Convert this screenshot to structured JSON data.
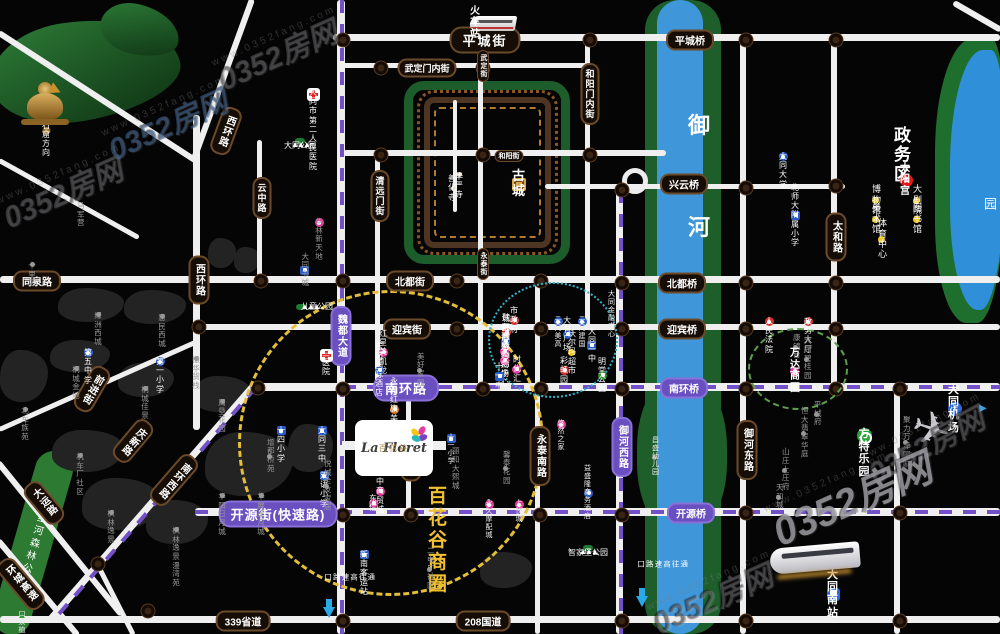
{
  "watermark": {
    "brand": "0352房网",
    "url": "www.0352fang.com"
  },
  "logo": {
    "latin": "La Floret",
    "cn": "百花谷"
  },
  "map": {
    "texts": {
      "shilihe": "十里河森林公园"
    },
    "colors": {
      "road": "#efefef",
      "river": "#3f96d8",
      "bank": "#1d5e2b",
      "route_dash": "#7150c8",
      "badge_dark": "#160d06",
      "badge_purple": "#6a4fc0",
      "circle_yellow": "#e2be3a",
      "circle_teal": "#35b0c5",
      "circle_green": "#5f9e4d",
      "biz_yellow": "#f0c030"
    },
    "roads": [
      [
        333,
        34,
        667,
        7,
        0
      ],
      [
        343,
        63,
        250,
        5,
        0
      ],
      [
        343,
        150,
        323,
        6,
        0
      ],
      [
        545,
        184,
        300,
        5,
        0
      ],
      [
        0,
        276,
        1000,
        7,
        0
      ],
      [
        197,
        324,
        803,
        6,
        0
      ],
      [
        258,
        383,
        742,
        8,
        0
      ],
      [
        195,
        508,
        805,
        8,
        0
      ],
      [
        0,
        616,
        1000,
        7,
        0
      ],
      [
        337,
        0,
        634,
        8,
        90
      ],
      [
        478,
        37,
        353,
        5,
        90
      ],
      [
        585,
        37,
        293,
        5,
        90
      ],
      [
        375,
        150,
        240,
        5,
        90
      ],
      [
        257,
        140,
        141,
        5,
        90
      ],
      [
        193,
        115,
        315,
        7,
        90
      ],
      [
        616,
        185,
        449,
        7,
        90
      ],
      [
        740,
        37,
        597,
        6,
        90
      ],
      [
        831,
        37,
        353,
        6,
        90
      ],
      [
        894,
        386,
        248,
        6,
        90
      ],
      [
        406,
        386,
        129,
        5,
        90
      ],
      [
        535,
        278,
        356,
        5,
        90
      ],
      [
        453,
        100,
        112,
        4,
        90
      ],
      [
        255,
        0,
        170,
        6,
        110
      ],
      [
        0,
        30,
        236,
        6,
        33
      ],
      [
        0,
        158,
        160,
        5,
        29
      ],
      [
        258,
        386,
        314,
        7,
        131
      ],
      [
        200,
        343,
        219,
        5,
        156
      ],
      [
        0,
        460,
        197,
        6,
        51
      ],
      [
        0,
        538,
        125,
        6,
        50
      ],
      [
        98,
        560,
        83,
        5,
        63
      ],
      [
        955,
        0,
        55,
        6,
        30
      ]
    ],
    "route_dashes": [
      [
        340,
        0,
        634,
        4,
        90
      ],
      [
        619,
        190,
        444,
        4,
        90
      ],
      [
        343,
        385,
        657,
        4,
        0
      ],
      [
        195,
        510,
        805,
        4,
        0
      ],
      [
        258,
        388,
        310,
        4,
        131
      ]
    ],
    "junctions": [
      [
        343,
        40
      ],
      [
        457,
        40
      ],
      [
        590,
        40
      ],
      [
        746,
        40
      ],
      [
        836,
        40
      ],
      [
        381,
        68
      ],
      [
        483,
        68
      ],
      [
        381,
        155
      ],
      [
        483,
        155
      ],
      [
        590,
        155
      ],
      [
        622,
        190
      ],
      [
        746,
        188
      ],
      [
        836,
        186
      ],
      [
        261,
        281
      ],
      [
        343,
        281
      ],
      [
        457,
        281
      ],
      [
        541,
        281
      ],
      [
        622,
        283
      ],
      [
        746,
        283
      ],
      [
        836,
        283
      ],
      [
        199,
        327
      ],
      [
        343,
        329
      ],
      [
        457,
        329
      ],
      [
        541,
        329
      ],
      [
        622,
        329
      ],
      [
        746,
        329
      ],
      [
        836,
        329
      ],
      [
        258,
        388
      ],
      [
        343,
        389
      ],
      [
        411,
        389
      ],
      [
        483,
        389
      ],
      [
        541,
        389
      ],
      [
        622,
        389
      ],
      [
        746,
        389
      ],
      [
        836,
        389
      ],
      [
        900,
        389
      ],
      [
        343,
        515
      ],
      [
        411,
        515
      ],
      [
        540,
        515
      ],
      [
        622,
        515
      ],
      [
        746,
        513
      ],
      [
        900,
        513
      ],
      [
        343,
        621
      ],
      [
        622,
        621
      ],
      [
        746,
        621
      ],
      [
        900,
        621
      ],
      [
        98,
        564
      ],
      [
        148,
        611
      ]
    ],
    "blocks": [
      [
        58,
        288,
        66,
        34
      ],
      [
        124,
        290,
        62,
        34
      ],
      [
        50,
        340,
        60,
        32
      ],
      [
        0,
        350,
        48,
        52
      ],
      [
        118,
        363,
        56,
        34
      ],
      [
        193,
        376,
        58,
        36
      ],
      [
        52,
        430,
        72,
        42
      ],
      [
        82,
        478,
        78,
        52
      ],
      [
        146,
        500,
        62,
        44
      ],
      [
        205,
        432,
        88,
        64
      ],
      [
        288,
        424,
        45,
        48
      ],
      [
        208,
        238,
        28,
        30
      ],
      [
        234,
        247,
        26,
        26
      ],
      [
        480,
        552,
        52,
        36
      ]
    ],
    "road_badges": [
      [
        "平城街",
        485,
        40,
        "h",
        "db",
        0
      ],
      [
        "平城桥",
        690,
        40,
        "h",
        "d",
        0
      ],
      [
        "武定门内街",
        427,
        68,
        "h",
        "ds",
        0
      ],
      [
        "武定街",
        483,
        66,
        "v",
        "dt",
        0
      ],
      [
        "和阳门内街",
        590,
        94,
        "v",
        "ds",
        0
      ],
      [
        "西环路",
        226,
        131,
        "v",
        "d",
        20
      ],
      [
        "西环路",
        199,
        280,
        "v",
        "d",
        0
      ],
      [
        "云中路",
        262,
        198,
        "v",
        "ds",
        0
      ],
      [
        "清远门街",
        380,
        196,
        "v",
        "ds",
        0
      ],
      [
        "和阳街",
        509,
        156,
        "h",
        "dt",
        0
      ],
      [
        "永泰街",
        483,
        264,
        "v",
        "dt",
        0
      ],
      [
        "同泉路",
        37,
        281,
        "h",
        "d",
        0
      ],
      [
        "北都街",
        410,
        281,
        "h",
        "d",
        0
      ],
      [
        "迎宾街",
        407,
        329,
        "h",
        "d",
        0
      ],
      [
        "兴云桥",
        684,
        184,
        "h",
        "d",
        0
      ],
      [
        "北都桥",
        682,
        283,
        "h",
        "d",
        0
      ],
      [
        "迎宾桥",
        682,
        329,
        "h",
        "d",
        0
      ],
      [
        "太和路",
        836,
        237,
        "v",
        "d",
        0
      ],
      [
        "御河东路",
        747,
        450,
        "v",
        "d",
        0
      ],
      [
        "红旗街",
        411,
        457,
        "v",
        "d",
        0
      ],
      [
        "永泰南路",
        540,
        456,
        "v",
        "d",
        0
      ],
      [
        "南环西路",
        174,
        480,
        "v",
        "d",
        41
      ],
      [
        "前进街",
        92,
        389,
        "v",
        "d",
        30
      ],
      [
        "大运路",
        44,
        503,
        "v",
        "d",
        -40
      ],
      [
        "环城高速",
        21,
        584,
        "v",
        "d",
        -40
      ],
      [
        "庆新路",
        133,
        441,
        "v",
        "d",
        40
      ],
      [
        "339省道",
        243,
        621,
        "h",
        "d",
        0
      ],
      [
        "208国道",
        483,
        621,
        "h",
        "d",
        0
      ],
      [
        "魏都大道",
        341,
        336,
        "v",
        "p",
        0
      ],
      [
        "御河西路",
        622,
        447,
        "v",
        "p",
        0
      ],
      [
        "南环路",
        406,
        388,
        "h",
        "pb",
        0
      ],
      [
        "南环桥",
        684,
        388,
        "h",
        "p",
        0
      ],
      [
        "开源街(快速路)",
        278,
        514,
        "h",
        "pb",
        0
      ],
      [
        "开源桥",
        691,
        513,
        "h",
        "p",
        0
      ]
    ],
    "pois": [
      [
        "火车站",
        470,
        23,
        "b10",
        "train",
        "l"
      ],
      [
        "云冈石窟方向",
        42,
        130,
        "w8",
        "golddot",
        "l"
      ],
      [
        "大同市第二\n人民医院",
        313,
        88,
        "w8",
        "cross",
        "t"
      ],
      [
        "大同公园",
        300,
        141,
        "pk",
        "trees",
        "t"
      ],
      [
        "古城",
        512,
        184,
        "b12",
        "goldcity",
        "l"
      ],
      [
        "华严寺",
        459,
        172,
        "w8",
        "wdot",
        "t"
      ],
      [
        "善化寺",
        456,
        188,
        "w8",
        "wdot",
        "r"
      ],
      [
        "政务区",
        894,
        155,
        "big",
        null,
        null
      ],
      [
        "太阳宫",
        900,
        180,
        "b10",
        "redstar",
        "l"
      ],
      [
        "博物馆",
        872,
        200,
        "w9",
        "ydot",
        "l"
      ],
      [
        "大剧院",
        913,
        200,
        "w9",
        "ydot",
        "l"
      ],
      [
        "美术馆",
        872,
        219,
        "w9",
        "ydot",
        "l"
      ],
      [
        "图书馆",
        913,
        219,
        "w9",
        "ydot",
        "l"
      ],
      [
        "体育中心",
        878,
        239,
        "w9",
        "ydot",
        "l"
      ],
      [
        "文瀛湖公园",
        981,
        207,
        "vp",
        null,
        null
      ],
      [
        "御",
        688,
        126,
        "rv",
        null,
        null
      ],
      [
        "河",
        688,
        228,
        "rv",
        null,
        null
      ],
      [
        "大同大学",
        783,
        152,
        "w8",
        "blue",
        "t"
      ],
      [
        "北师大附属小学",
        791,
        215,
        "w8",
        "bluesq",
        "l"
      ],
      [
        "华林\n新天地",
        319,
        218,
        "g",
        "pink",
        "t"
      ],
      [
        "马军营",
        77,
        215,
        "g",
        null,
        null
      ],
      [
        "十里店",
        32,
        262,
        "g",
        "graydot",
        "t"
      ],
      [
        "大同书城",
        309,
        270,
        "g",
        "bluesq",
        "r"
      ],
      [
        "儿童公园",
        301,
        307,
        "pkh",
        "trees",
        "l"
      ],
      [
        "三医院",
        326,
        349,
        "w8",
        "cross",
        "t"
      ],
      [
        "绿洲西城",
        98,
        312,
        "g",
        "graydot",
        "t"
      ],
      [
        "惠民西城",
        162,
        314,
        "g",
        "graydot",
        "t"
      ],
      [
        "第五中学",
        88,
        348,
        "w8",
        "blue",
        "t"
      ],
      [
        "桐城金地",
        76,
        366,
        "g",
        "graydot",
        "t"
      ],
      [
        "第一小学",
        160,
        357,
        "w8",
        "blue",
        "t"
      ],
      [
        "振华货栈",
        196,
        356,
        "g",
        "graydot",
        "t"
      ],
      [
        "桐城佳景",
        145,
        386,
        "g",
        "graydot",
        "t"
      ],
      [
        "周垦花园",
        222,
        399,
        "g",
        "graydot",
        "t"
      ],
      [
        "北车族苑",
        25,
        407,
        "g",
        "graydot",
        "t"
      ],
      [
        "红星美凯龙",
        379,
        352,
        "w8",
        "pink",
        "l"
      ],
      [
        "云冈国际酒店",
        375,
        370,
        "w8",
        "blue",
        "l"
      ],
      [
        "美好家园",
        417,
        370,
        "g",
        "graydot",
        "l"
      ],
      [
        "市政府",
        510,
        320,
        "w8",
        "red",
        "l"
      ],
      [
        "城区政府",
        502,
        332,
        "w8",
        "red",
        "l"
      ],
      [
        "魏都国际酒店",
        510,
        341,
        "w8",
        "blue",
        "r"
      ],
      [
        "尚都购物广场",
        509,
        351,
        "w8",
        "pink",
        "r"
      ],
      [
        "百盛购物中心",
        509,
        360,
        "w8",
        "pink",
        "r"
      ],
      [
        "时代汇",
        521,
        369,
        "w8",
        "pink",
        "r"
      ],
      [
        "十一中",
        495,
        376,
        "w8",
        "bluesq",
        "l"
      ],
      [
        "云冈美高",
        558,
        317,
        "w7",
        "blue",
        "t"
      ],
      [
        "云冈建国",
        582,
        317,
        "w7",
        "blue",
        "t"
      ],
      [
        "大同金融中心",
        608,
        315,
        "w7",
        null,
        null
      ],
      [
        "大有广场",
        563,
        334,
        "w8",
        "blue",
        "l"
      ],
      [
        "沃尔玛超市",
        568,
        352,
        "w8",
        "ydot",
        "l"
      ],
      [
        "大同一中",
        596,
        345,
        "w8",
        "bluesq",
        "r"
      ],
      [
        "彩虹园",
        560,
        370,
        "w8",
        "red",
        "l"
      ],
      [
        "明堂公园",
        598,
        375,
        "w8",
        "green",
        "l"
      ],
      [
        "人民法院",
        769,
        317,
        "w8",
        "red",
        "t"
      ],
      [
        "政务大厅",
        808,
        317,
        "w8",
        "red",
        "t"
      ],
      [
        "康镜台",
        793,
        347,
        "g",
        "graydot",
        "l"
      ],
      [
        "大同碧桂园",
        804,
        359,
        "g",
        "graydot",
        "l"
      ],
      [
        "万达商圈",
        790,
        371,
        "b10",
        "pink",
        "l"
      ],
      [
        "十四小学",
        281,
        426,
        "w8",
        "bluesq",
        "t"
      ],
      [
        "大同三中",
        322,
        426,
        "w8",
        "bluesq",
        "t"
      ],
      [
        "增都桥苑",
        267,
        456,
        "g",
        "graydot",
        "l"
      ],
      [
        "双语小学",
        324,
        471,
        "w8",
        "bluesq",
        "t"
      ],
      [
        "悦城全友家居",
        324,
        486,
        "g",
        "graydot",
        "l"
      ],
      [
        "华阳日月城",
        222,
        493,
        "g",
        "graydot",
        "t"
      ],
      [
        "华展星月城",
        261,
        493,
        "g",
        "graydot",
        "t"
      ],
      [
        "机车厂社区",
        80,
        453,
        "g",
        "graydot",
        "t"
      ],
      [
        "枫林逸景",
        111,
        510,
        "g",
        "graydot",
        "t"
      ],
      [
        "枫林逸景\n漫湾苑",
        176,
        527,
        "g",
        "graydot",
        "t"
      ],
      [
        "永和红旗美食城",
        390,
        409,
        "w8",
        "orange",
        "l"
      ],
      [
        "十一小学",
        451,
        434,
        "w7",
        "bluesq",
        "t"
      ],
      [
        "丽和\n大熙城",
        452,
        469,
        "g",
        null,
        null
      ],
      [
        "馨泰花园",
        503,
        468,
        "g",
        "graydot",
        "l"
      ],
      [
        "悠然之家",
        561,
        420,
        "w7",
        "pink",
        "t"
      ],
      [
        "昌盛幼儿园",
        652,
        457,
        "w7",
        "graydot",
        "l"
      ],
      [
        "云中商贸城",
        376,
        491,
        "w8",
        "pink",
        "l"
      ],
      [
        "东信",
        369,
        503,
        "w8",
        "pink",
        "l"
      ],
      [
        "永久\n摩配城",
        489,
        500,
        "w7",
        "pink",
        "t"
      ],
      [
        "上悦城",
        519,
        500,
        "w7",
        "pink",
        "t"
      ],
      [
        "益盛隆商务酒店",
        584,
        493,
        "w7",
        "blue",
        "l"
      ],
      [
        "平城府",
        814,
        414,
        "g",
        "graydot",
        "l"
      ],
      [
        "恒大翡翠华庭",
        801,
        433,
        "g",
        "graydot",
        "l"
      ],
      [
        "山庄上庄府",
        782,
        470,
        "g",
        "graydot",
        "l"
      ],
      [
        "天和城",
        776,
        497,
        "g",
        "graydot",
        "l"
      ],
      [
        "聚力万泽国际",
        903,
        442,
        "g",
        "graydot",
        "l"
      ],
      [
        "方特乐园",
        864,
        428,
        "b11",
        "greenswirl",
        "t"
      ],
      [
        "大同机场",
        948,
        409,
        "b11",
        "plane",
        "l"
      ],
      [
        "",
        978,
        409,
        "w7",
        "bluetri",
        "l"
      ],
      [
        "百花谷商圈",
        428,
        541,
        "by",
        null,
        null
      ],
      [
        "二电厂社区",
        427,
        569,
        "g",
        "graydot",
        "l"
      ],
      [
        "新南\n客运站",
        364,
        550,
        "w8",
        "bluesq",
        "t"
      ],
      [
        "智家堡公园",
        588,
        548,
        "pk",
        "trees",
        "t"
      ],
      [
        "大同南站",
        827,
        594,
        "b11",
        "metro",
        "l"
      ],
      [
        "通往高速路口",
        323,
        577,
        "vs",
        null,
        null
      ],
      [
        "",
        323,
        612,
        "w7",
        "bluearrow",
        "l"
      ],
      [
        "通往高速路口",
        636,
        564,
        "vs",
        null,
        null
      ],
      [
        "",
        636,
        601,
        "w7",
        "bluearrow",
        "l"
      ],
      [
        "口泉植物园",
        22,
        611,
        "w7",
        "treesm",
        "t"
      ]
    ]
  }
}
